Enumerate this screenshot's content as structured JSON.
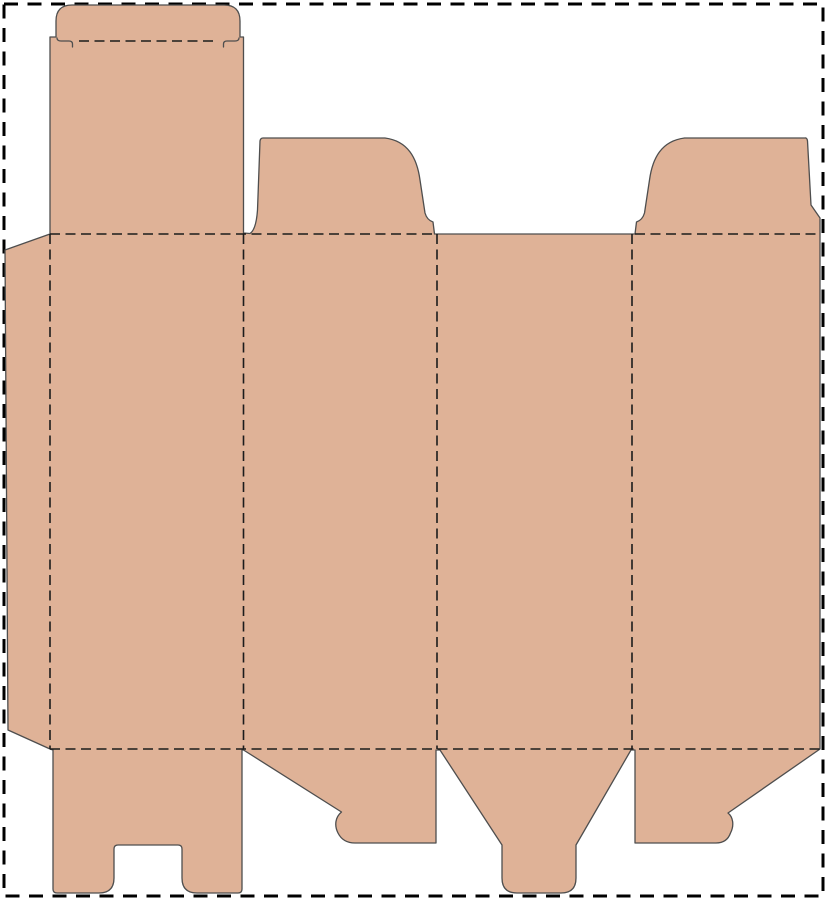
{
  "meta": {
    "title": "Box dieline template",
    "description": "Unfolded carton die-cut template: solid lines are cut lines, dashed lines are fold lines"
  },
  "canvas": {
    "width": 827,
    "height": 900
  },
  "colors": {
    "background": "#ffffff",
    "board_fill": "#dfb297",
    "cut_stroke": "#4e4e4e",
    "fold_stroke": "#1c1c1c",
    "page_border": "#000000"
  },
  "line_styles": {
    "fold_dash": "10 5.5",
    "border_dash": "14 9.5"
  },
  "legend": {
    "solid_line_meaning": "cut",
    "dashed_line_meaning": "fold"
  },
  "parts": {
    "page_border": "sheet boundary (dashed)",
    "glue_flap": "left side glue flap",
    "tuck_flap": "top tuck-in lid flap with shoulder slits",
    "tall_panel": "panel 1 with tuck lid above",
    "top_dust_flap_left": "top dust flap over panel 2",
    "top_dust_flap_right": "top dust flap over panel 4",
    "main_body": "four vertical panels divided by fold lines",
    "bottom_flap_notched": "bottom flap with center notch (two legs)",
    "bottom_dust_flap_left": "angled bottom dust flap under panel 2",
    "bottom_tuck_flap": "tapered bottom tuck flap under panel 3",
    "bottom_dust_flap_right": "angled bottom dust flap under panel 4"
  }
}
